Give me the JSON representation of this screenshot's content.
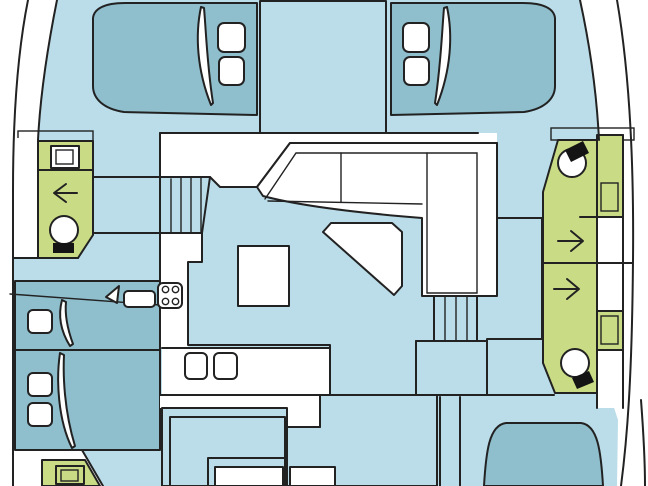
{
  "title": "catamaran-deck-plan",
  "colors": {
    "background": "#ffffff",
    "hull_interior": "#badde9",
    "bed": "#8fbecd",
    "salon_floor": "#fbd88e",
    "bathroom": "#c9dc85",
    "cockpit_floor": "#c2ae98",
    "fixture_white": "#ffffff",
    "toilet_tank": "#141414",
    "outline": "#222222"
  },
  "legend": {
    "hull_interior": "walkways and hull interior",
    "bed": "berths / cushions",
    "salon_floor": "salon and galley floor",
    "bathroom": "heads (bathrooms) with shower arrows, sinks and toilets",
    "cockpit_floor": "aft cockpit floor",
    "fixture_white": "furniture: sofa, table, counters, hatches"
  },
  "fixtures": {
    "bow_cabins": 2,
    "side_cabins": 2,
    "bathrooms": 4,
    "toilets": 3,
    "shower_arrows": 3,
    "stove_burners": 4,
    "galley_sinks": 2,
    "stair_flights": 2
  }
}
